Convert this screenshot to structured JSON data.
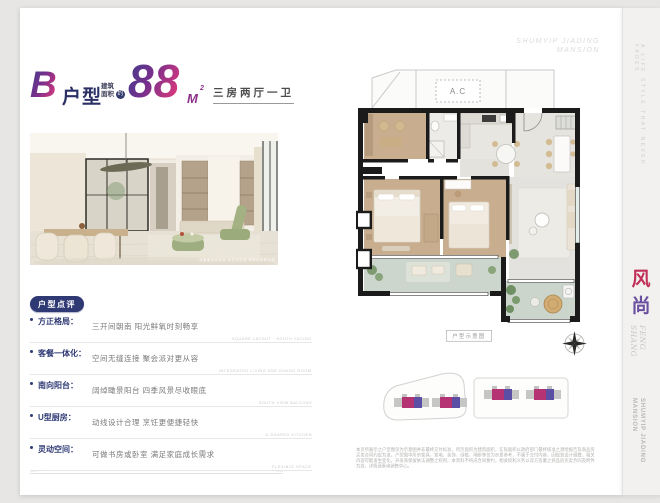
{
  "header": {
    "unit_letter": "B",
    "unit_word": "户型",
    "area_prefix_1": "建筑",
    "area_prefix_2": "面积",
    "area_circle": "约",
    "area_value": "88",
    "area_unit": "M",
    "area_sup": "2",
    "layout_tag": "三房两厅一卫"
  },
  "watermark": {
    "line1": "SHUMYIP JIADING",
    "line2": "MANSION"
  },
  "photo": {
    "caption": "效果图仅供参考 非交付标准 具体以实际为准"
  },
  "review": {
    "badge": "户型点评",
    "items": [
      {
        "label": "方正格局：",
        "text": "三开间朝南 阳光鲜氧时刻畅享",
        "note": "SQUARE LAYOUT · SOUTH FACING"
      },
      {
        "label": "客餐一体化：",
        "text": "空间无缝连接 聚会派对更从容",
        "note": "INTEGRATED LIVING AND DINING ROOM"
      },
      {
        "label": "南向阳台：",
        "text": "阔绰瞰景阳台 四季风景尽收眼底",
        "note": "SOUTH VIEW BALCONY"
      },
      {
        "label": "U型厨房：",
        "text": "动线设计合理 烹饪更便捷轻快",
        "note": "U-SHAPED KITCHEN"
      },
      {
        "label": "灵动空间：",
        "text": "可做书房或卧室 满足家庭成长需求",
        "note": "FLEXIBLE SPACE"
      }
    ]
  },
  "floorplan": {
    "ac_label": "A.C",
    "diagram_tag": "户型示意图"
  },
  "sidebar": {
    "tagline": "A LIFE STYLE THAT NEVER FADES",
    "zh_char_1": "风",
    "zh_char_2": "尚",
    "pinyin_1": "FENG",
    "pinyin_2": "SHANG",
    "brand_1": "SHUMYIP JIADING",
    "brand_2": "MANSION"
  },
  "footer": {
    "left_mark": "—— · ·",
    "right_mark": "· · ——"
  },
  "disclaimer": "本页所展示之户型图仅为示意图并非最终交付标准，所示面积为建筑面积，实际面积以政府部门最终核准之测绘报告及商品房买卖合同约定为准。户型图中所示家具、家电、装饰、绿植、隔断等仅为示意参考，不属于交付内容。因规划设计调整，相关内容可能发生变化，开发商保留依法调整之权利。本资料不构成合同要约，相关权利义务以双方签署之商品房买卖合同及附件为准，详情请垂询销售中心。",
  "colors": {
    "navy": "#2f3a74",
    "gradient_start": "#3e3d8f",
    "gradient_end": "#e23a7c",
    "feng_red": "#c03058",
    "shang_purple": "#6a4fa0",
    "building_magenta": "#b53273",
    "building_purple": "#5b4fa5"
  }
}
